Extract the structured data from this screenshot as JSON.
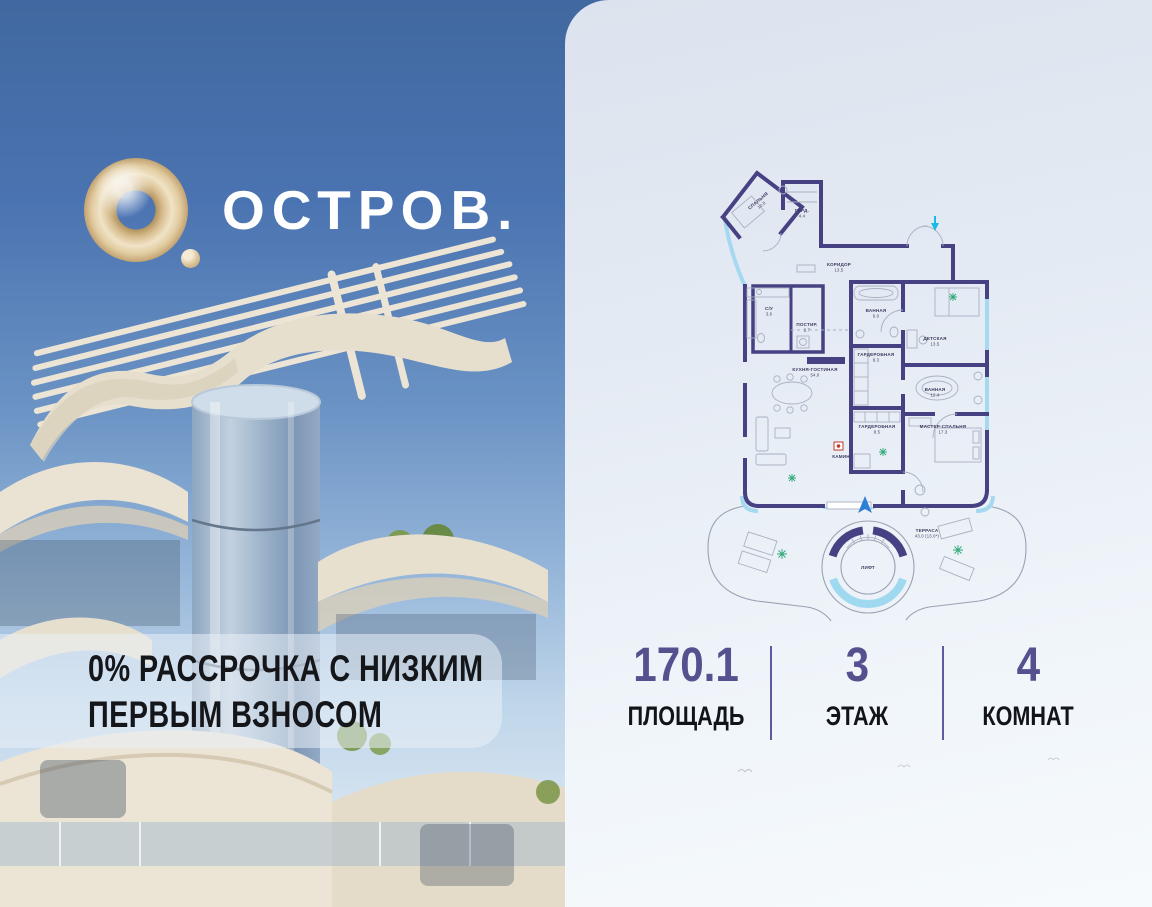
{
  "brand": {
    "logo_icon": "gold-ring-logo",
    "logo_text": "ОСТРОВ."
  },
  "promo": {
    "line1": "0% РАССРОЧКА С НИЗКИМ",
    "line2": "ПЕРВЫМ ВЗНОСОМ"
  },
  "stats": {
    "items": [
      {
        "value": "170.1",
        "label": "ПЛОЩАДЬ"
      },
      {
        "value": "3",
        "label": "ЭТАЖ"
      },
      {
        "value": "4",
        "label": "КОМНАТ"
      }
    ]
  },
  "floor_plan": {
    "rooms": [
      {
        "id": "bedroom",
        "name": "СПАЛЬНЯ",
        "area": "10.8",
        "x": 64,
        "y": 42,
        "angle": -40
      },
      {
        "id": "wardrobe-entry",
        "name": "ГАРД.",
        "area": "4.4",
        "x": 107,
        "y": 52
      },
      {
        "id": "corridor",
        "name": "КОРИДОР",
        "area": "13.5",
        "x": 144,
        "y": 106
      },
      {
        "id": "wc",
        "name": "С/У",
        "area": "3.6",
        "x": 74,
        "y": 150
      },
      {
        "id": "laundry",
        "name": "ПОСТИР.",
        "area": "2.7",
        "x": 112,
        "y": 166
      },
      {
        "id": "bath-1",
        "name": "ВАННАЯ",
        "area": "6.0",
        "x": 181,
        "y": 152
      },
      {
        "id": "kids-room",
        "name": "ДЕТСКАЯ",
        "area": "13.5",
        "x": 240,
        "y": 180
      },
      {
        "id": "closet-1",
        "name": "ГАРДЕРОБНАЯ",
        "area": "8.3",
        "x": 181,
        "y": 196
      },
      {
        "id": "kitchen-living",
        "name": "КУХНЯ-ГОСТИНАЯ",
        "area": "54.0",
        "x": 120,
        "y": 211
      },
      {
        "id": "bath-2",
        "name": "ВАННАЯ",
        "area": "12.4",
        "x": 240,
        "y": 231
      },
      {
        "id": "closet-2",
        "name": "ГАРДЕРОБНАЯ",
        "area": "8.5",
        "x": 182,
        "y": 268
      },
      {
        "id": "master-bedroom",
        "name": "МАСТЕР-СПАЛЬНЯ",
        "area": "17.3",
        "x": 248,
        "y": 268
      },
      {
        "id": "fireplace",
        "name": "КАМИН",
        "area": "",
        "x": 146,
        "y": 298
      },
      {
        "id": "terrace",
        "name": "ТЕРРАСА",
        "area": "43.0 (13.0*)",
        "x": 232,
        "y": 372
      },
      {
        "id": "elevator",
        "name": "ЛИФТ",
        "area": "",
        "x": 173,
        "y": 409
      }
    ]
  },
  "colors": {
    "accent_purple": "#55518f",
    "plan_wall": "#454183",
    "plan_window": "#a6d9f0",
    "logo_gold": "#d8bd8e",
    "sky_top": "#446cae",
    "entry_marker_cyan": "#19b9e8",
    "north_arrow_blue": "#2f7fd6",
    "plant_green": "#2ea876",
    "fireplace_red": "#c0392b"
  }
}
